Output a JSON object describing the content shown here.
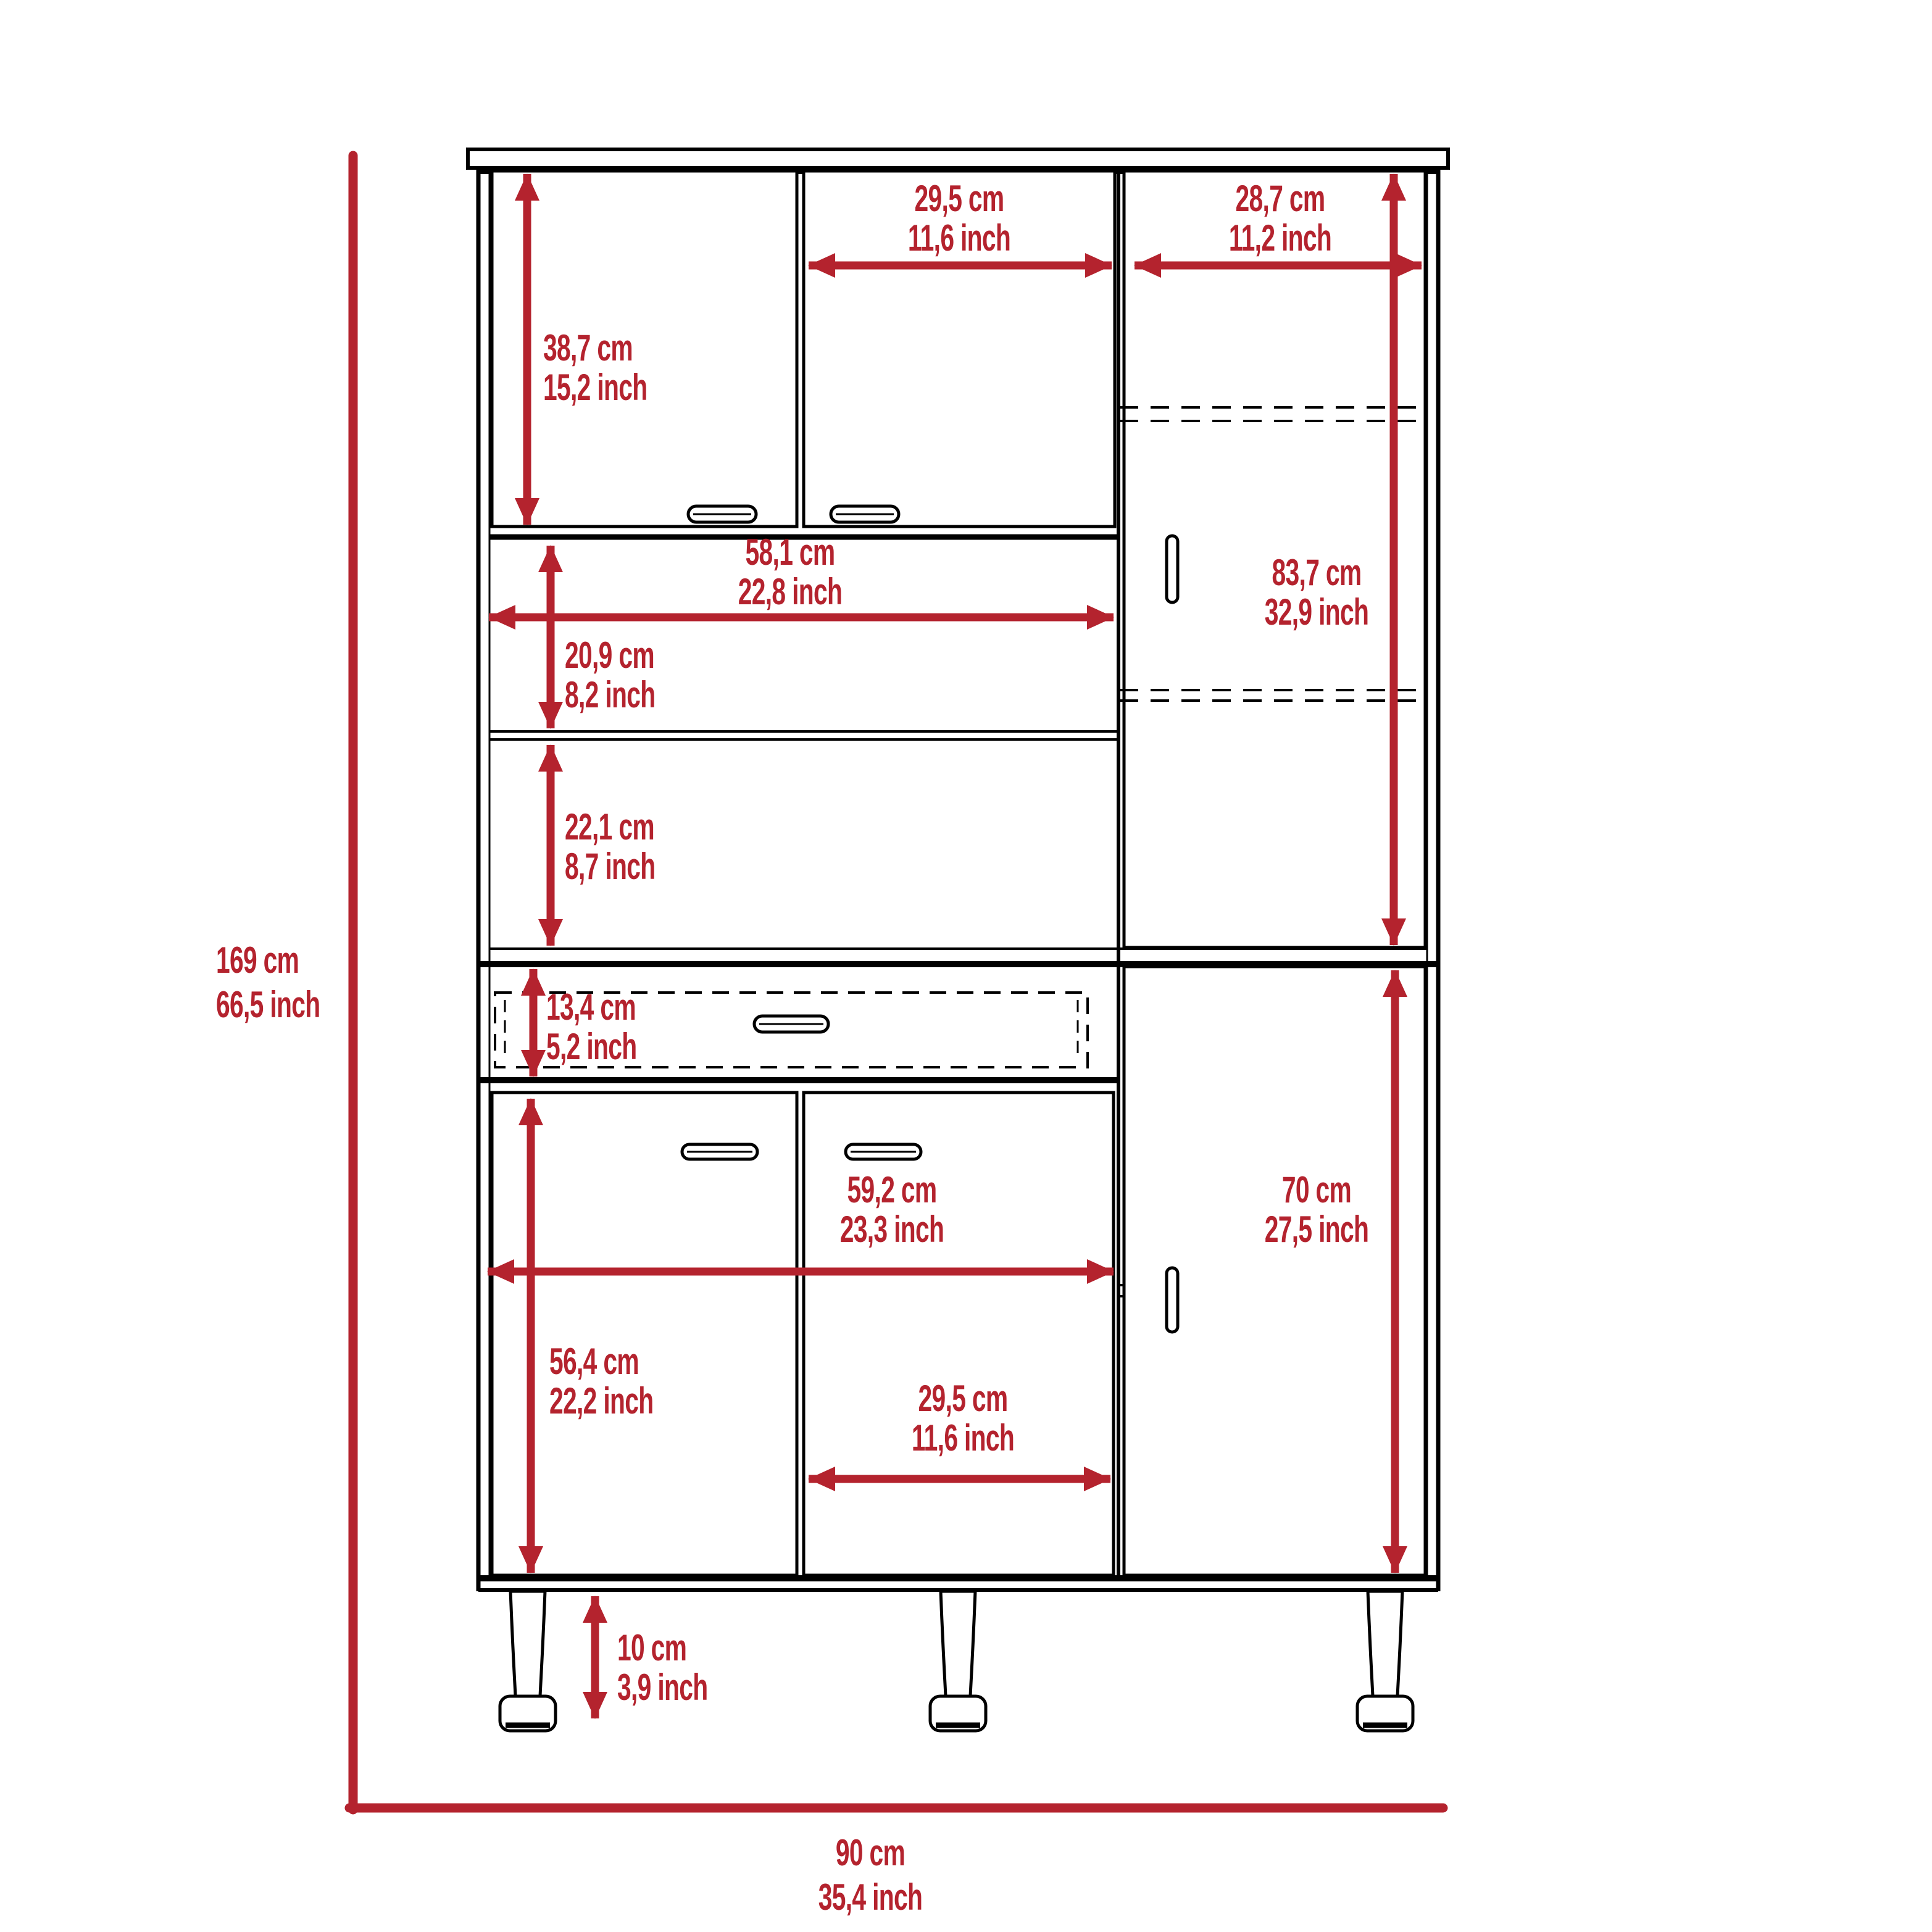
{
  "figure": {
    "kind": "furniture-dimension-diagram",
    "subject": "pantry cabinet front elevation with six doors, one drawer, open shelves and three legs",
    "background": "#ffffff"
  },
  "colors": {
    "dimension_red": "#b4232e",
    "line_black": "#000000"
  },
  "overall": {
    "height": {
      "cm": "169 cm",
      "inch": "66,5 inch"
    },
    "width": {
      "cm": "90 cm",
      "inch": "35,4 inch"
    }
  },
  "dims": {
    "top_left_door_height": {
      "cm": "38,7 cm",
      "inch": "15,2 inch"
    },
    "top_middle_door_width": {
      "cm": "29,5 cm",
      "inch": "11,6 inch"
    },
    "top_right_door_width": {
      "cm": "28,7 cm",
      "inch": "11,2 inch"
    },
    "shelf_width": {
      "cm": "58,1 cm",
      "inch": "22,8 inch"
    },
    "upper_shelf_height": {
      "cm": "20,9 cm",
      "inch": "8,2 inch"
    },
    "lower_shelf_height": {
      "cm": "22,1 cm",
      "inch": "8,7 inch"
    },
    "upper_right_door_height": {
      "cm": "83,7 cm",
      "inch": "32,9 inch"
    },
    "drawer_height": {
      "cm": "13,4 cm",
      "inch": "5,2 inch"
    },
    "bottom_doors_width": {
      "cm": "59,2 cm",
      "inch": "23,3 inch"
    },
    "bottom_right_door_height": {
      "cm": "70 cm",
      "inch": "27,5 inch"
    },
    "bottom_left_door_height": {
      "cm": "56,4 cm",
      "inch": "22,2 inch"
    },
    "bottom_middle_door_width": {
      "cm": "29,5 cm",
      "inch": "11,6 inch"
    },
    "leg_height": {
      "cm": "10 cm",
      "inch": "3,9 inch"
    }
  }
}
